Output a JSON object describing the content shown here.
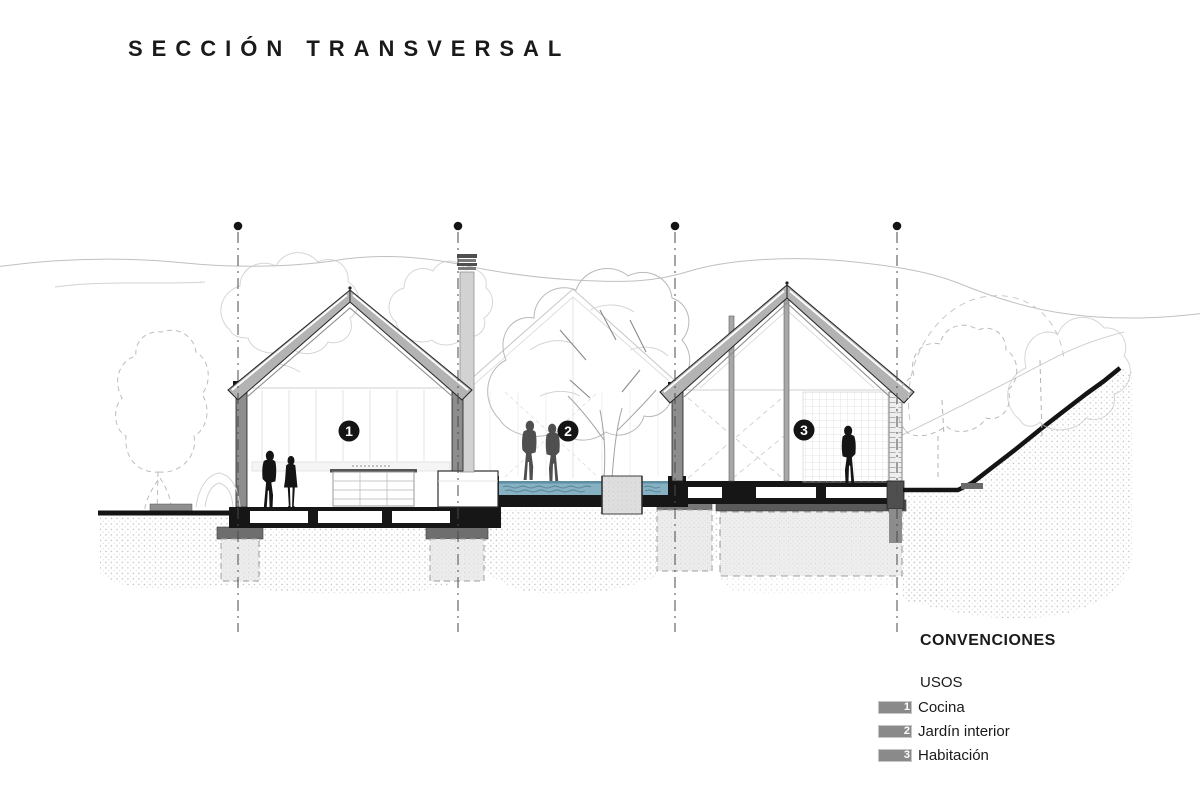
{
  "title": "SECCIÓN TRANSVERSAL",
  "markers": [
    "1",
    "2",
    "3"
  ],
  "legend": {
    "heading": "CONVENCIONES",
    "group_label": "USOS",
    "items": [
      {
        "num": "1",
        "label": "Cocina"
      },
      {
        "num": "2",
        "label": "Jardín interior"
      },
      {
        "num": "3",
        "label": "Habitación"
      }
    ]
  },
  "colors": {
    "ink": "#141414",
    "roof_fill": "#b3b3b3",
    "wall_fill": "#8d8d8d",
    "water": "#86b1c2",
    "water_line": "#4e7b8c",
    "people_foreground": "#141414",
    "people_midground": "#4f4f4f",
    "legend_swatch": "#8a8a8a",
    "sketch_gray": "#c0c0c0"
  }
}
